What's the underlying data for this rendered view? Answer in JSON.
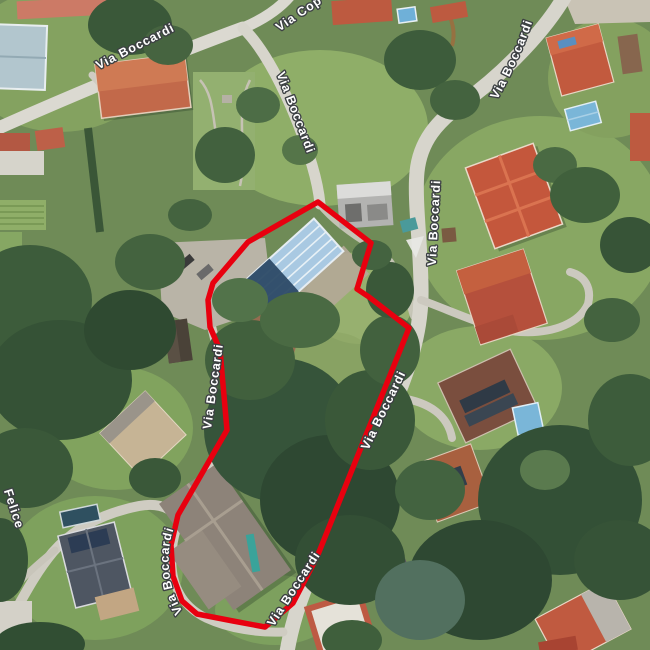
{
  "map": {
    "street_labels": {
      "via_boccardi": "Via Boccardi",
      "via_cop": "Via Cop",
      "felice": "Felice"
    },
    "boundary": {
      "stroke_color": "#e8000f"
    },
    "label_style": {
      "text_fill": "#ffffff",
      "text_outline": "#3c4043"
    }
  }
}
